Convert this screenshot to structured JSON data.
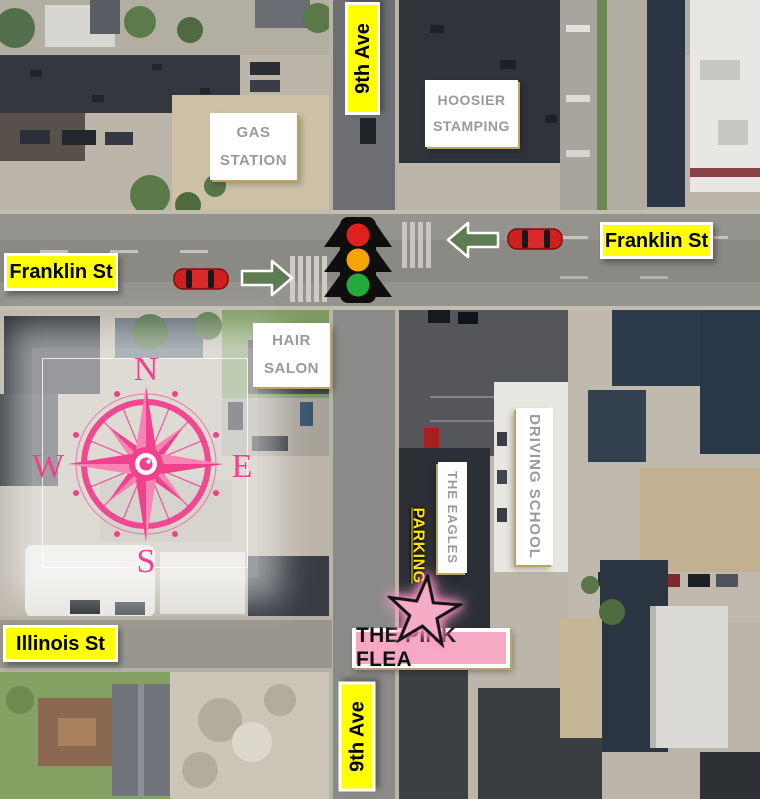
{
  "streets": {
    "ninth_ave_top": "9th Ave",
    "ninth_ave_bottom": "9th Ave",
    "franklin_left": "Franklin St",
    "franklin_right": "Franklin St",
    "illinois": "Illinois St"
  },
  "places": {
    "hoosier_stamping": "HOOSIER STAMPING",
    "gas_station": "GAS STATION",
    "hair_salon": "HAIR SALON",
    "driving_school": "DRIVING SCHOOL",
    "the_eagles": "THE EAGLES"
  },
  "annotations": {
    "parking": "PARKING",
    "destination": "THE PINK FLEA"
  },
  "compass": {
    "north": "N",
    "east": "E",
    "south": "S",
    "west": "W"
  },
  "icons": {
    "traffic_light": "traffic-light-icon",
    "red_car": "red-car-icon",
    "green_arrow": "green-arrow-icon",
    "compass_rose": "compass-rose-icon",
    "star": "star-icon"
  },
  "colors": {
    "street_label_bg": "#ffff00",
    "street_label_text": "#000000",
    "place_label_bg": "#ffffff",
    "place_label_text": "#9a9a9a",
    "destination_bg": "#f7a8c4",
    "star_fill": "#f6abc6",
    "compass_pink": "#f1418c",
    "arrow_green": "#5d7c52",
    "car_red": "#cf1f1f",
    "parking_text": "#ffe600",
    "traffic_red": "#e11f1f",
    "traffic_amber": "#f7a300",
    "traffic_green": "#25a93b"
  }
}
